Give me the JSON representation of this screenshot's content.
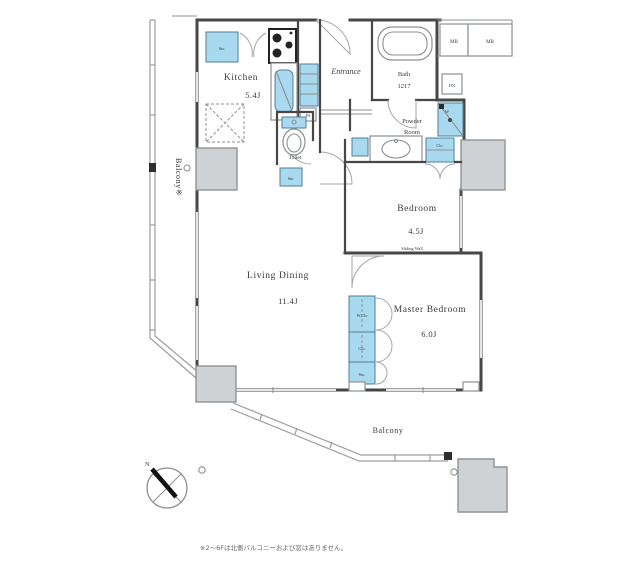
{
  "plan": {
    "balcony_left_label": "Balcony※",
    "balcony_bottom_label": "Balcony",
    "rooms": {
      "kitchen": {
        "name": "Kitchen",
        "size": "5.4J"
      },
      "entrance": {
        "name": "Entrance"
      },
      "bath": {
        "name": "Bath",
        "size": "1217"
      },
      "powder_room": {
        "line1": "Powder",
        "line2": "Room"
      },
      "toilet": {
        "name": "Toilet"
      },
      "bedroom": {
        "name": "Bedroom",
        "size": "4.5J"
      },
      "living_dining": {
        "name": "Living Dining",
        "size": "11.4J"
      },
      "master_bedroom": {
        "name": "Master Bedroom",
        "size": "6.0J"
      }
    },
    "labels": {
      "meter_box_1": "MB",
      "meter_box_2": "MB",
      "down": "DN",
      "pipe_space": "PS",
      "kitchen_storage": "Sto.",
      "hall_storage": "Sto.",
      "washer": "W",
      "linen_closet": "Clo.",
      "walk_in_closet": "W.Clo",
      "closet": "Clo.",
      "storage": "Sto.",
      "sliding_wall": "Sliding Wall",
      "north": "N"
    },
    "footnote": "※2〜6Fは北側バルコニーおよび窓はありません。"
  },
  "colors": {
    "fixture_blue": "#a9d9ee",
    "wall": "#474747",
    "pillar_gray": "#ced2d5",
    "background": "#ffffff"
  }
}
